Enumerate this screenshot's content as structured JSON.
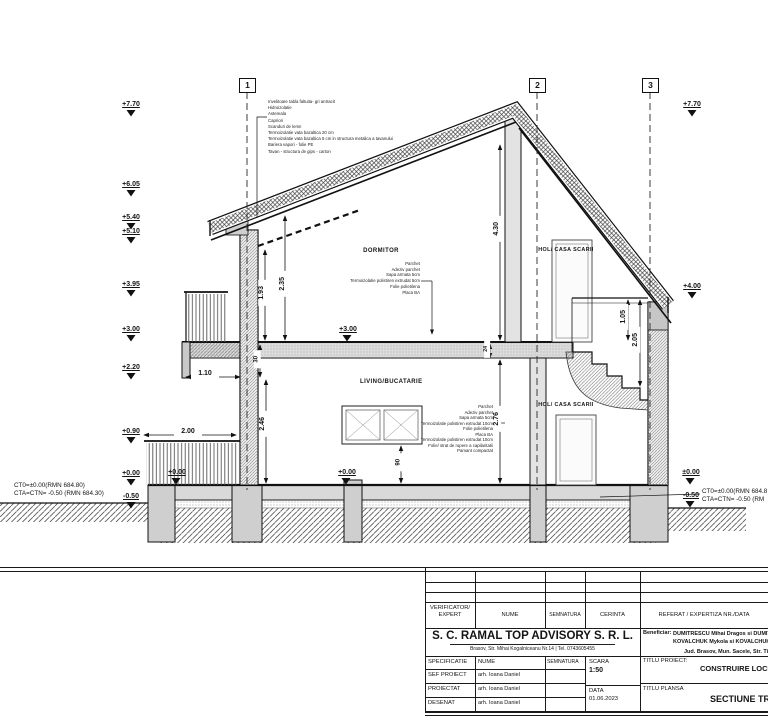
{
  "sections": [
    "1",
    "2",
    "3"
  ],
  "levels": {
    "left": [
      "+7.70",
      "+6.05",
      "+5.40",
      "+5.10",
      "+3.95",
      "+3.00",
      "+2.20",
      "+0.90",
      "+0.00",
      "-0.50"
    ],
    "right": [
      "+7.70",
      "+4.00"
    ],
    "inline_terrace": "+0.00",
    "inline_slab": "+0.00",
    "inline_floor1": "+3.00",
    "inline_right_zero": "±0.00",
    "inline_right_minus": "-0.50",
    "ct_left_1": "CT0=±0.00(RMN 684.80)",
    "ct_left_2": "CTA=CTN= -0.50 (RMN 684.30)",
    "ct_right_1": "CT0=±0.00(RMN 684.8",
    "ct_right_2": "CTA=CTN= -0.50 (RM"
  },
  "rooms": {
    "dormitor": "DORMITOR",
    "hol_up": "HOL/ CASA SCARII",
    "living": "LIVING/BUCATARIE",
    "hol_down": "HOL/ CASA SCARII"
  },
  "dims": {
    "h193": "1.93",
    "h235": "2.35",
    "h430": "4.30",
    "h246": "2.46",
    "h276": "2.76",
    "h90": "90",
    "h30": "30",
    "h24": "24",
    "h105": "1.05",
    "h205": "2.05",
    "w110": "1.10",
    "w200": "2.00"
  },
  "notes": {
    "roof": [
      "Invelitoare tabla faltuita- gri antracit",
      "Hidroizolatie",
      "Astereala",
      "Capriori",
      "Scanduri de lemn",
      "Termoizolatie vata bazaltica 20 cm",
      "Termoizolatie vata bazaltica 5 cm in structura metalica a tavanului",
      "Bariera vapori - folie PE",
      "Tavan - structura de gips - carton"
    ],
    "floor1": [
      "Parchet",
      "Adeziv parchet",
      "Sapa armata 5cm",
      "Termoizolatie polistiren extrudat 5cm",
      "Folie polietilena",
      "Placa BA"
    ],
    "floor0": [
      "Parchet",
      "Adeziv parchet",
      "Sapa armata 5cm",
      "Termoizolatie polistiren extrudat 10cm",
      "Folie polietilena",
      "Placa BA",
      "Termoizolatie polistiren extrudat 10cm",
      "Folie/ strat de rupere a capilaritatii",
      "Pamant compactat"
    ]
  },
  "titleblock": {
    "verificator": "VERIFICATOR/\nEXPERT",
    "nume": "NUME",
    "semnatura": "SEMNATURA",
    "cerinta": "CERINTA",
    "referat": "REFERAT / EXPERTIZA NR./DATA",
    "company": "S. C. RAMAL TOP ADVISORY  S. R. L.",
    "address": "Brasov, Str.   Mihai Kogalniceanu Nr.14 | Tel. 0743605455",
    "beneficiar_label": "Beneficiar:",
    "beneficiar1": "DUMITRESCU Mihai Dragos si DUMITR",
    "beneficiar2": "KOVALCHUK Mykola si KOVALCHUK Natali",
    "beneficiar3": "Jud. Brasov, Mun. Sacele, Str. Tim",
    "titlu_proiect_label": "TITLU PROIECT:",
    "titlu_proiect": "CONSTRUIRE LOCUINT",
    "titlu_plansa_label": "TITLU PLANSA",
    "titlu_plansa": "SECTIUNE TRAN",
    "specificatie": "SPECIFICATIE",
    "nume2": "NUME",
    "semnatura2": "SEMNATURA",
    "scara_label": "SCARA",
    "scara": "1:50",
    "data_label": "DATA",
    "data": "01.06.2023",
    "rows": [
      {
        "label": "SEF PROIECT",
        "name": "arh. Ioana Daniel"
      },
      {
        "label": "PROIECTAT",
        "name": "arh. Ioana Daniel"
      },
      {
        "label": "DESENAT",
        "name": "arh. Ioana Daniel"
      }
    ]
  }
}
